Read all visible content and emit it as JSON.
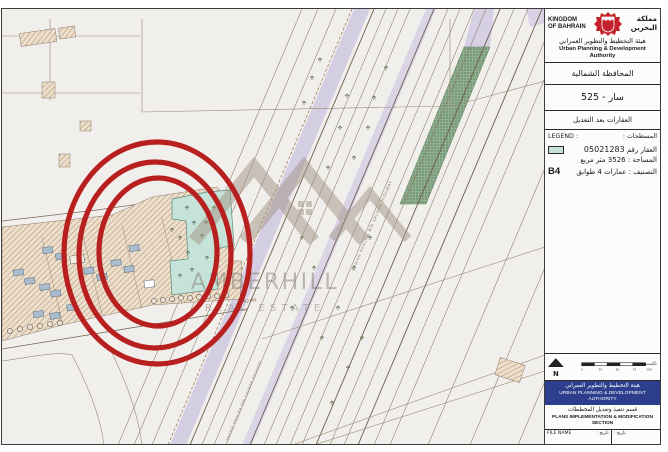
{
  "header": {
    "kingdom_line1": "KINGDOM",
    "kingdom_line2": "OF BAHRAIN",
    "kingdom_ar_line1": "مملكة",
    "kingdom_ar_line2": "البحرين",
    "authority_ar": "هيئة التخطيط والتطوير العمراني",
    "authority_en": "Urban Planning & Development Authority"
  },
  "title_rows": {
    "governorate_ar": "المحافظة الشمالية",
    "block_title": "سار - 525",
    "subtitle_ar": "العقارات بعد التعديل"
  },
  "legend": {
    "label_en": "LEGEND :",
    "label_ar": ": المسطحات",
    "property_label_ar": "العقار رقم",
    "property_number": "05021283",
    "area_line_ar": "المساحة : 3526 متر مربع",
    "class_label_ar": "التصنيف : عمارات 4 طوابق",
    "class_code": "B4",
    "swatch_color": "#c6e3da"
  },
  "map": {
    "road_label": "R2142",
    "highway_label": "SHAIKH KHALIFA BIN SALMAN HIGHWAY",
    "watermark_title": "AMBERHILL",
    "watermark_subtitle": "REAL ESTATE",
    "highlight_color": "#b81f1f",
    "property_fill": "#c6e3da"
  },
  "footer": {
    "north_label": "N",
    "scale_ticks": [
      "0",
      "25",
      "50",
      "75",
      "100"
    ],
    "scale_unit": "متر",
    "authority_ar": "هيئة التخطيط والتطوير العمراني",
    "authority_en": "URBAN PLANNING & DEVELOPMENT AUTHORITY",
    "section_ar": "قسم تنفيذ وتعديل المخططات",
    "section_en": "PLANS IMPLEMENTATION & MODIFICATION SECTION",
    "file_name_label": "FILE NAME",
    "date_label": "تاريخ :"
  }
}
